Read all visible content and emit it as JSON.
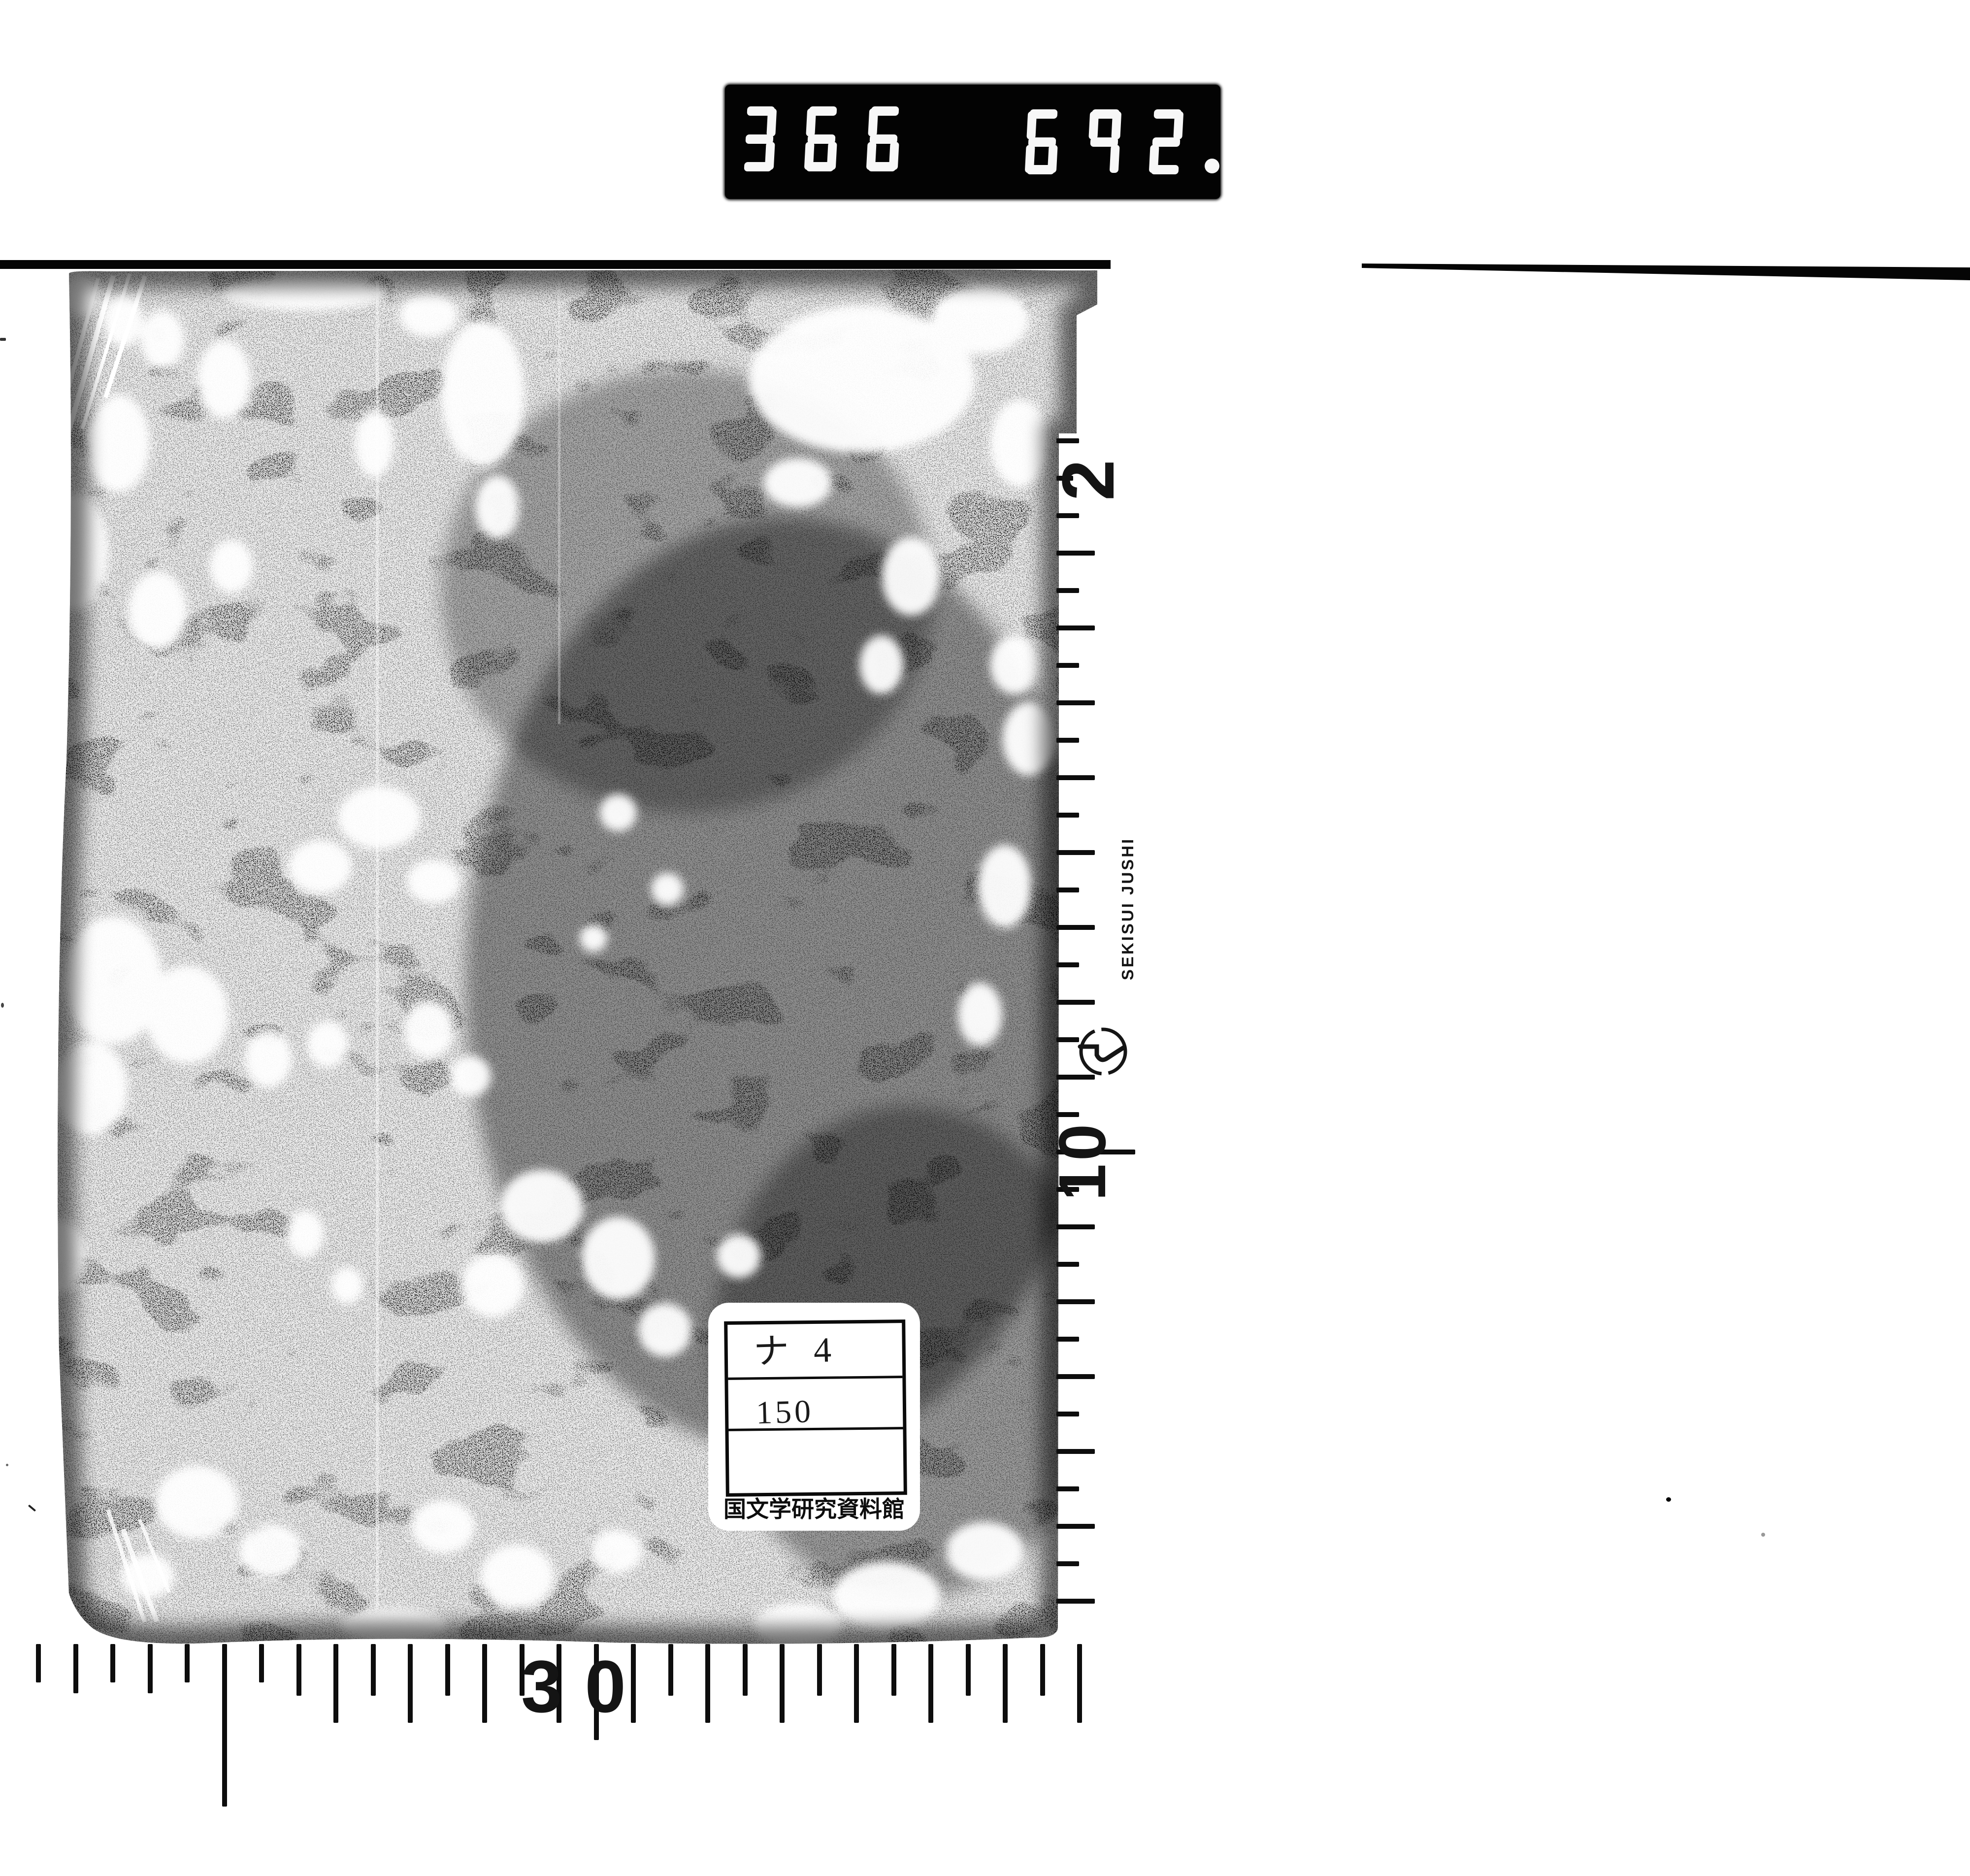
{
  "film_counter": {
    "left_digits": "366",
    "right_digits": "692",
    "has_decimal_point": true,
    "bg_color": "#030303",
    "digit_color": "#f7f7f7"
  },
  "vertical_ruler": {
    "label_top": "2",
    "label_mid": "10",
    "brand": "SEKISUI JUSHI",
    "logo": "sekisui-circle-mark",
    "tick_count": 32
  },
  "bottom_ruler": {
    "label": "30",
    "tick_count": 29
  },
  "label_card": {
    "row1": "ナ 4",
    "row2": "150",
    "row3": "",
    "institution": "国文学研究資料館"
  }
}
